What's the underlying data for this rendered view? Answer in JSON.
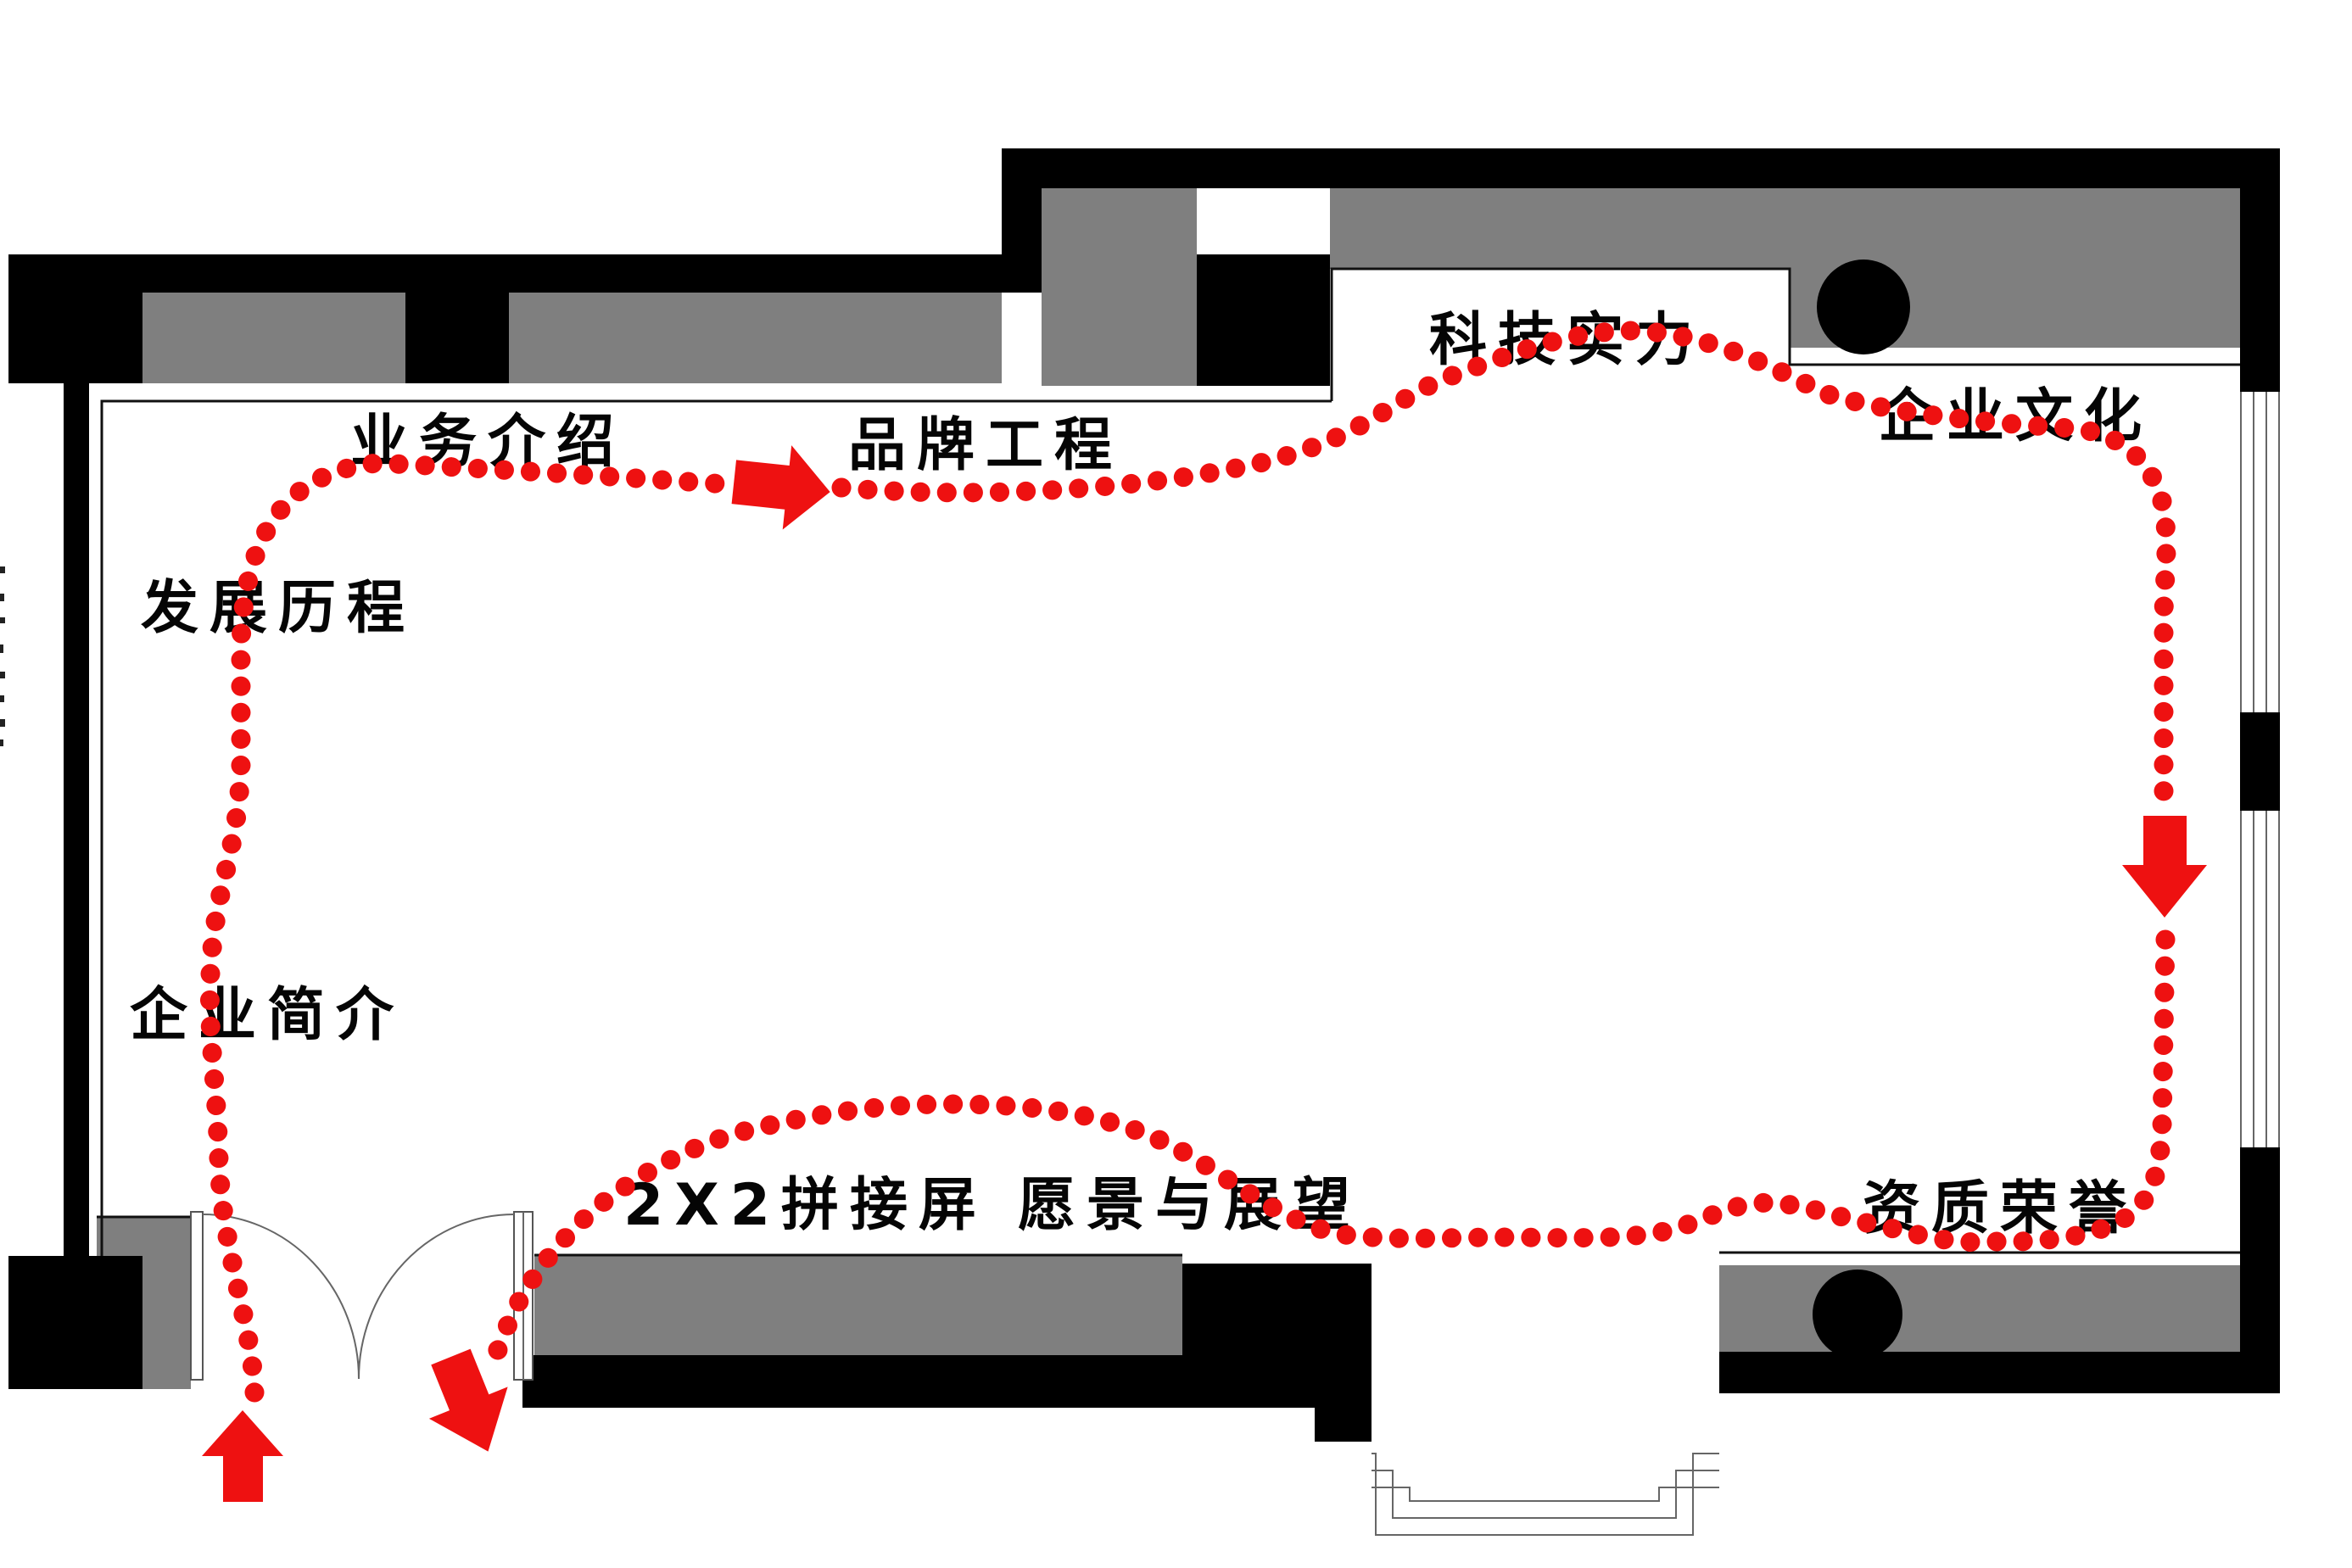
{
  "diagram": {
    "type": "exhibition-hall-floor-plan-with-visitor-route",
    "labels": {
      "business_intro": "业务介绍",
      "brand_project": "品牌工程",
      "tech_strength": "科技实力",
      "corporate_culture": "企业文化",
      "development_history": "发展历程",
      "company_profile": "企业简介",
      "splicing_screen": "2X2拼接屏",
      "vision_outlook": "愿景与展望",
      "qualification_honor": "资质荣誉"
    },
    "route": {
      "color": "#ee1111",
      "line_style": "dotted",
      "arrows": {
        "entry": "up",
        "top_flow": "right",
        "right_flow": "down",
        "exit": "down-right"
      }
    },
    "colors": {
      "wall": "#000000",
      "display_panel": "#7f7f7f",
      "floor": "#ffffff",
      "route": "#ee1111"
    }
  }
}
